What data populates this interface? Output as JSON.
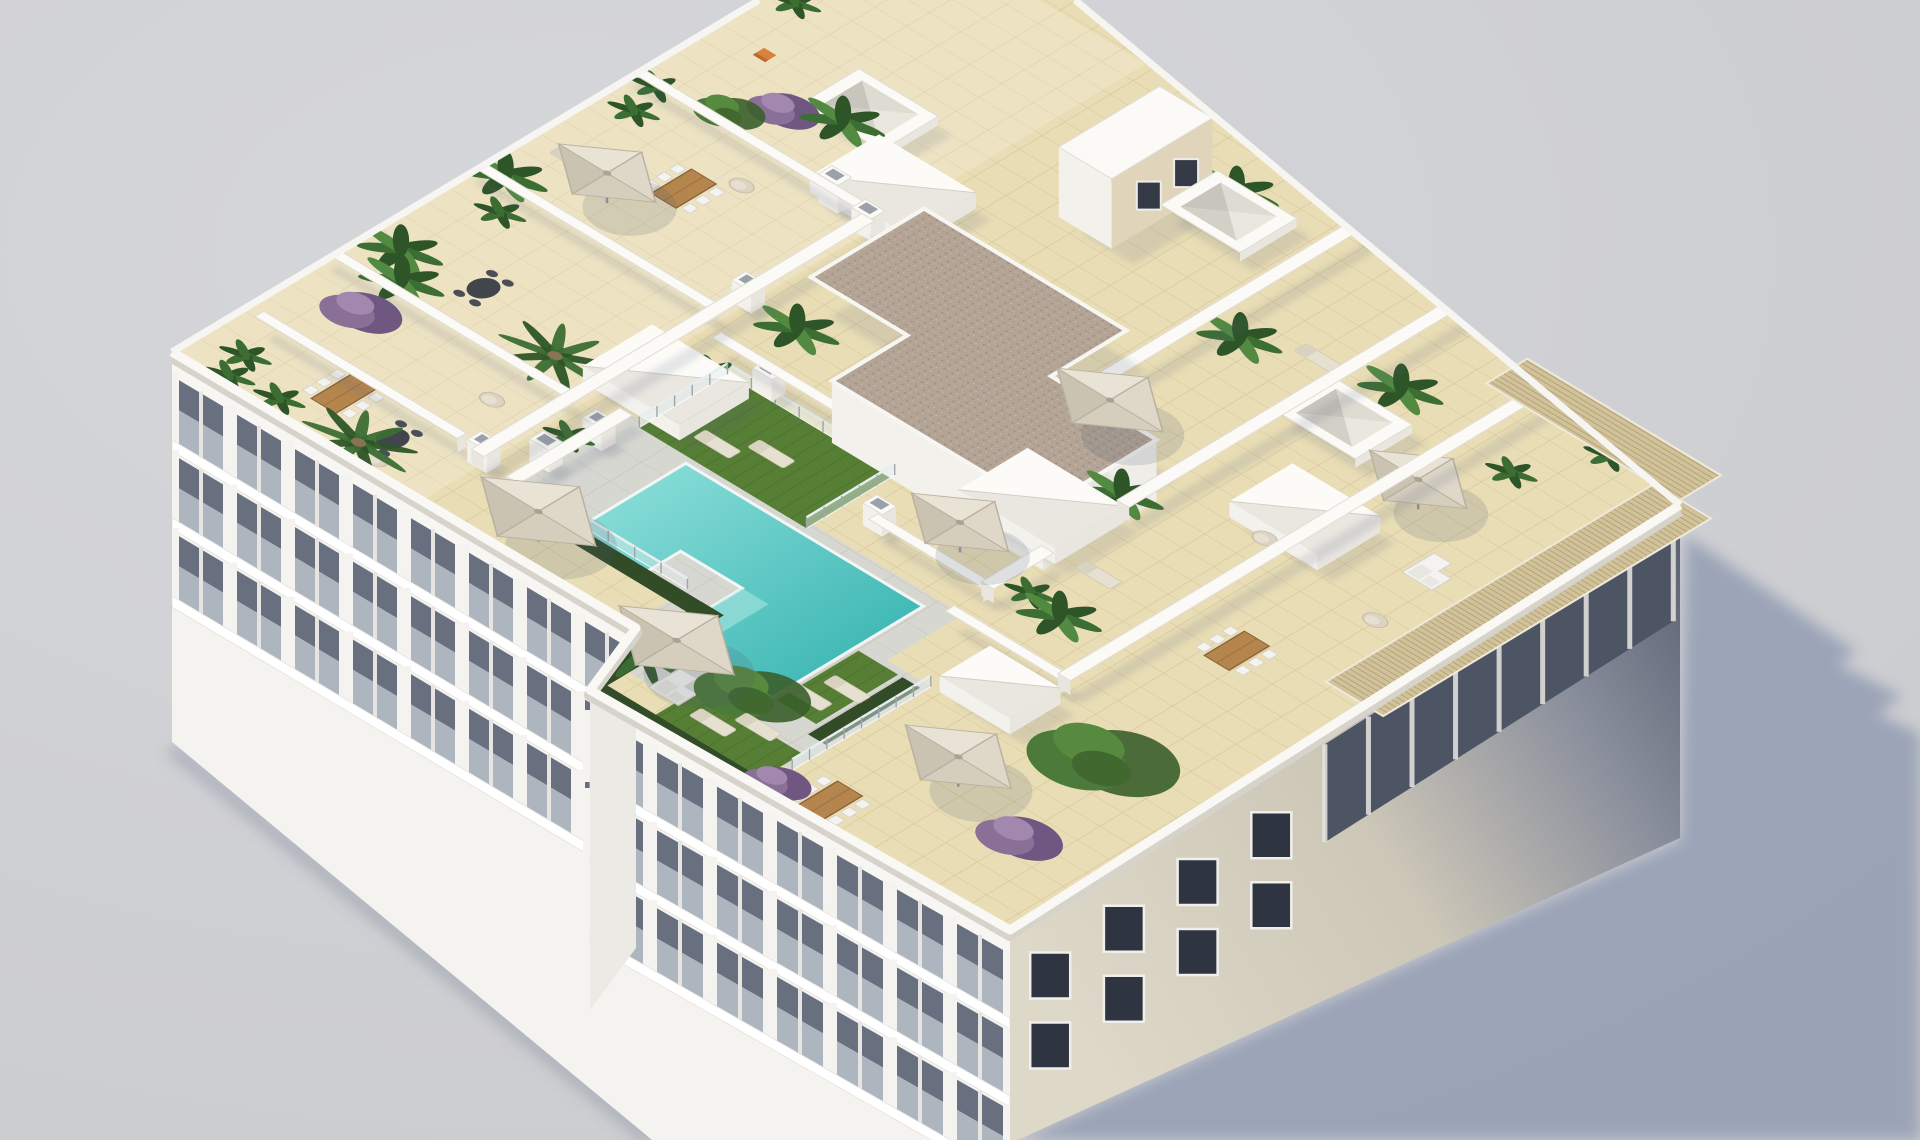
{
  "image": {
    "kind": "3d-architectural-render",
    "subject": "aerial isometric view of a white apartment building rooftop solarium with communal pool, tiled terraces, parasols, plants and outdoor furniture",
    "width": 1920,
    "height": 1140
  },
  "palette": {
    "bg": "#c9cacd",
    "bgHi": "#d6d7da",
    "groundShadow": "#98a1b6",
    "tile": "#e9ddb5",
    "tileLine": "#cdbb8d",
    "deck": "#d7d7d1",
    "deckLine": "#c2c2bb",
    "wallTop": "#fbfaf7",
    "wallFace": "#e9e6df",
    "wallFace2": "#f3f1ec",
    "wallEdge": "#e0ddd5",
    "poolLight": "#93e2dc",
    "poolDark": "#2fb0ae",
    "poolRim": "#f2f6f4",
    "grass": "#567e34",
    "grassLine": "#49702c",
    "hedge": "#324c28",
    "gravel": "#b3a496",
    "gravelDot": "#978a7c",
    "gravelDot2": "#c8bcae",
    "pergola": "#d2c29a",
    "pergolaStripe": "#a8996f",
    "facade": "#f4f3f0",
    "facadeBand": "#687080",
    "railGlass": "rgba(196,204,212,0.75)",
    "slab": "#ffffff",
    "rightA": "#ded8c9",
    "rightB": "#cdc7b8",
    "rightC": "#8a8f9c",
    "rightD": "#565d6e",
    "window": "#2e3440",
    "windowFrame": "#f0efec",
    "recess": "#4d5464",
    "mullion": "#e8e6e0",
    "wood": "#b5854e",
    "woodDark": "#8a6238",
    "furn": "#f4f3ef",
    "furnEdge": "#d7d4cc",
    "canopy1": "#e9e3d5",
    "canopy2": "#d5cebd",
    "canopy3": "#dfd8c8",
    "canopy4": "#cac3b1",
    "pole": "#8c8f94",
    "leaf": "#3c6d33",
    "leafDark": "#2d5527",
    "leafLight": "#538a42",
    "trunk": "#8a7354",
    "pot": "#c9beac",
    "potDark": "#b3a894",
    "purple": "#8a6f96",
    "purpleDark": "#6f5781",
    "purpleLight": "#a287ae",
    "orange": "#d9823f",
    "ao": "rgba(80,92,120,0.14)"
  },
  "iso": {
    "a": 6.3,
    "b": -3.8,
    "c": 8.8,
    "d": 5.3,
    "e": 170,
    "f": 350
  },
  "outlines": {
    "roof": [
      [
        759,
        0
      ],
      [
        1075,
        0
      ],
      [
        1680,
        505
      ],
      [
        1010,
        930
      ],
      [
        590,
        690
      ],
      [
        636,
        628
      ],
      [
        172,
        352
      ]
    ],
    "facadeLeft": [
      [
        172,
        352
      ],
      [
        636,
        628
      ],
      [
        590,
        690
      ],
      [
        1010,
        930
      ],
      [
        1012,
        1140
      ],
      [
        652,
        1140
      ],
      [
        172,
        742
      ]
    ],
    "facadeRight": [
      [
        1010,
        930
      ],
      [
        1680,
        505
      ],
      [
        1680,
        838
      ],
      [
        1018,
        1140
      ],
      [
        1010,
        1140
      ]
    ],
    "shadow": [
      [
        1686,
        535
      ],
      [
        1857,
        652
      ],
      [
        1838,
        664
      ],
      [
        1902,
        696
      ],
      [
        1878,
        714
      ],
      [
        1920,
        734
      ],
      [
        1920,
        1140
      ],
      [
        1018,
        1140
      ],
      [
        1680,
        840
      ]
    ]
  },
  "facades": {
    "left": {
      "A": [
        172,
        352
      ],
      "B": [
        636,
        628
      ],
      "bays": 8
    },
    "wing": {
      "A": [
        590,
        690
      ],
      "B": [
        1010,
        930
      ],
      "bays": 7
    },
    "step": [
      [
        636,
        628
      ],
      [
        590,
        690
      ],
      [
        590,
        1010
      ],
      [
        636,
        948
      ]
    ],
    "right": {
      "A": [
        1010,
        930
      ],
      "B": [
        1680,
        505
      ]
    }
  },
  "floor": {
    "deck": [
      [
        8,
        32
      ],
      [
        28,
        32
      ],
      [
        28,
        70
      ],
      [
        16,
        70
      ],
      [
        16,
        75
      ],
      [
        -6,
        75
      ],
      [
        -6,
        52
      ],
      [
        8,
        52
      ]
    ],
    "pool": [
      [
        26,
        40
      ],
      [
        26,
        67
      ],
      [
        2,
        67
      ],
      [
        2,
        55
      ],
      [
        14,
        55
      ],
      [
        14,
        48
      ],
      [
        8,
        48
      ],
      [
        8,
        40
      ]
    ],
    "grass": [
      [
        [
          27,
          34
        ],
        [
          41,
          34
        ],
        [
          41,
          53
        ],
        [
          27,
          53
        ]
      ],
      [
        [
          2,
          67.5
        ],
        [
          15,
          67.5
        ],
        [
          15,
          72
        ],
        [
          2,
          72
        ]
      ],
      [
        [
          -11,
          62
        ],
        [
          -3,
          62
        ],
        [
          -3,
          74
        ],
        [
          -11,
          74
        ]
      ]
    ],
    "hedges": [
      [
        [
          6.5,
          33
        ],
        [
          9,
          33
        ],
        [
          9,
          56
        ],
        [
          6.5,
          56
        ]
      ],
      [
        [
          -12,
          54
        ],
        [
          9,
          54
        ],
        [
          9,
          56.5
        ],
        [
          -12,
          56.5
        ]
      ],
      [
        [
          -12,
          56
        ],
        [
          -9.5,
          56
        ],
        [
          -9.5,
          76
        ],
        [
          -12,
          76
        ]
      ],
      [
        [
          0,
          72.5
        ],
        [
          15,
          72.5
        ],
        [
          15,
          74.5
        ],
        [
          0,
          74.5
        ]
      ]
    ],
    "topTerraceTint": [
      [
        0,
        0
      ],
      [
        115,
        0
      ],
      [
        115,
        28.5
      ],
      [
        0,
        28.5
      ]
    ],
    "gravel": [
      [
        75,
        32
      ],
      [
        75,
        55
      ],
      [
        63,
        55
      ],
      [
        63,
        67
      ],
      [
        45,
        67
      ],
      [
        45,
        43
      ],
      [
        57,
        43
      ],
      [
        57,
        32
      ]
    ],
    "pergola": [
      [
        [
          48,
          97
        ],
        [
          100,
          97
        ],
        [
          100,
          103.5
        ],
        [
          48,
          103.5
        ]
      ],
      [
        [
          100,
          78
        ],
        [
          106.5,
          78
        ],
        [
          106.5,
          100
        ],
        [
          100,
          100
        ]
      ]
    ]
  },
  "objects": [
    {
      "t": "wall",
      "a": [
        24,
        0
      ],
      "b": [
        24,
        28
      ]
    },
    {
      "t": "wall",
      "a": [
        47,
        0
      ],
      "b": [
        47,
        28
      ]
    },
    {
      "t": "wall",
      "a": [
        72,
        0
      ],
      "b": [
        72,
        28
      ]
    },
    {
      "t": "wall",
      "a": [
        9,
        28.5
      ],
      "b": [
        71,
        28.5
      ]
    },
    {
      "t": "wall",
      "a": [
        10,
        3
      ],
      "b": [
        10,
        26
      ]
    },
    {
      "t": "wall",
      "a": [
        43.5,
        31
      ],
      "b": [
        43.5,
        47
      ]
    },
    {
      "t": "wall",
      "a": [
        55.5,
        57
      ],
      "b": [
        115,
        57
      ]
    },
    {
      "t": "wall",
      "a": [
        32,
        57
      ],
      "b": [
        32,
        70
      ]
    },
    {
      "t": "wall",
      "a": [
        32,
        70
      ],
      "b": [
        41.5,
        70
      ]
    },
    {
      "t": "wall",
      "a": [
        53.5,
        70
      ],
      "b": [
        115,
        70
      ]
    },
    {
      "t": "wall",
      "a": [
        26,
        70
      ],
      "b": [
        26,
        83
      ]
    },
    {
      "t": "wall",
      "a": [
        26,
        83
      ],
      "b": [
        115,
        83
      ]
    },
    {
      "t": "wall",
      "a": [
        9,
        32.5
      ],
      "b": [
        27,
        32.5
      ],
      "h": 8
    },
    {
      "t": "gcore"
    },
    {
      "t": "hwall"
    },
    {
      "t": "chim",
      "c": [
        10,
        28.5
      ]
    },
    {
      "t": "chim",
      "c": [
        30,
        28.5
      ]
    },
    {
      "t": "chim",
      "c": [
        52,
        28.5
      ]
    },
    {
      "t": "chim",
      "c": [
        71,
        28.5
      ]
    },
    {
      "t": "chim",
      "c": [
        15,
        32
      ]
    },
    {
      "t": "chim",
      "c": [
        22,
        33
      ]
    },
    {
      "t": "chim",
      "c": [
        42,
        38
      ]
    },
    {
      "t": "chim",
      "c": [
        33,
        57
      ]
    },
    {
      "t": "chim",
      "c": [
        72,
        24
      ],
      "h": 28
    },
    {
      "t": "sky",
      "c": [
        86,
        18
      ],
      "w": 9
    },
    {
      "t": "sky",
      "c": [
        101,
        48
      ],
      "w": 9
    },
    {
      "t": "sky",
      "c": [
        83,
        74
      ],
      "w": 9
    },
    {
      "t": "vbox",
      "c": [
        34,
        32
      ],
      "w": 11
    },
    {
      "t": "vbox",
      "c": [
        77,
        27
      ],
      "w": 11
    },
    {
      "t": "vbox",
      "c": [
        49.5,
        50
      ],
      "w": 11
    },
    {
      "t": "vbox",
      "c": [
        47.5,
        65
      ],
      "w": 11
    },
    {
      "t": "vbox",
      "c": [
        67,
        81
      ],
      "w": 10
    },
    {
      "t": "vbox",
      "c": [
        20,
        80
      ],
      "w": 8
    },
    {
      "t": "glass",
      "a": [
        27,
        34
      ],
      "b": [
        41,
        34
      ]
    },
    {
      "t": "glass",
      "a": [
        41,
        34
      ],
      "b": [
        41,
        53
      ]
    },
    {
      "t": "glass",
      "a": [
        9.5,
        34
      ],
      "b": [
        9.5,
        52
      ]
    },
    {
      "t": "glass",
      "a": [
        -6,
        75
      ],
      "b": [
        16,
        75
      ]
    },
    {
      "t": "glass",
      "a": [
        27,
        53
      ],
      "b": [
        41,
        53
      ]
    },
    {
      "t": "umb",
      "c": [
        4,
        39
      ],
      "s": 6.5
    },
    {
      "t": "umb",
      "c": [
        -2,
        59
      ],
      "s": 6.5
    },
    {
      "t": "umb",
      "c": [
        54,
        11
      ],
      "s": 5.5
    },
    {
      "t": "umb",
      "c": [
        64,
        61
      ],
      "s": 6
    },
    {
      "t": "umb",
      "c": [
        36,
        64
      ],
      "s": 5.5
    },
    {
      "t": "umb",
      "c": [
        5,
        86
      ],
      "s": 6
    },
    {
      "t": "umb",
      "c": [
        78,
        86
      ],
      "s": 5.5
    },
    {
      "t": "table",
      "c": [
        8,
        14
      ]
    },
    {
      "t": "table",
      "c": [
        62,
        14
      ]
    },
    {
      "t": "table",
      "c": [
        63,
        43
      ]
    },
    {
      "t": "table",
      "c": [
        57,
        63
      ]
    },
    {
      "t": "table",
      "c": [
        45,
        89
      ]
    },
    {
      "t": "table",
      "c": [
        -7,
        80
      ]
    },
    {
      "t": "dtable",
      "c": [
        6,
        21
      ]
    },
    {
      "t": "dtable",
      "c": [
        33,
        12
      ]
    },
    {
      "t": "pouf",
      "c": [
        19,
        23
      ]
    },
    {
      "t": "pouf",
      "c": [
        67,
        17
      ]
    },
    {
      "t": "pouf",
      "c": [
        56,
        50
      ]
    },
    {
      "t": "pouf",
      "c": [
        62,
        80
      ]
    },
    {
      "t": "pouf",
      "c": [
        60,
        94
      ]
    },
    {
      "t": "pouf",
      "c": [
        2,
        22
      ]
    },
    {
      "t": "sofa",
      "c": [
        89,
        16
      ],
      "accent": true
    },
    {
      "t": "sofa",
      "c": [
        70,
        78
      ]
    },
    {
      "t": "sofa",
      "c": [
        71,
        92
      ]
    },
    {
      "t": "sofa",
      "c": [
        -4,
        60
      ]
    },
    {
      "t": "orange",
      "c": [
        86,
        6
      ]
    },
    {
      "t": "lounger",
      "c": [
        31,
        40
      ]
    },
    {
      "t": "lounger",
      "c": [
        34,
        44
      ]
    },
    {
      "t": "lounger",
      "c": [
        5,
        69
      ]
    },
    {
      "t": "lounger",
      "c": [
        9,
        70.5
      ]
    },
    {
      "t": "lounger",
      "c": [
        -6,
        66
      ]
    },
    {
      "t": "lounger",
      "c": [
        -3,
        69
      ]
    },
    {
      "t": "lounger",
      "c": [
        57,
        5
      ]
    },
    {
      "t": "lounger",
      "c": [
        60,
        7.5
      ]
    },
    {
      "t": "lounger",
      "c": [
        44,
        74
      ]
    },
    {
      "t": "lounger",
      "c": [
        90,
        66
      ]
    },
    {
      "t": "palm",
      "c": [
        2,
        20
      ]
    },
    {
      "t": "palm",
      "c": [
        29,
        23
      ]
    },
    {
      "t": "palm",
      "c": [
        -3,
        56
      ]
    },
    {
      "t": "paddle",
      "c": [
        27,
        7
      ]
    },
    {
      "t": "paddle",
      "c": [
        31,
        4
      ]
    },
    {
      "t": "paddle",
      "c": [
        52,
        34
      ]
    },
    {
      "t": "paddle",
      "c": [
        86,
        60
      ]
    },
    {
      "t": "paddle",
      "c": [
        56,
        68
      ]
    },
    {
      "t": "paddle",
      "c": [
        35,
        76
      ]
    },
    {
      "t": "paddle",
      "c": [
        105,
        46
      ]
    },
    {
      "t": "paddle",
      "c": [
        92,
        74
      ]
    },
    {
      "t": "paddle",
      "c": [
        49,
        3
      ]
    },
    {
      "t": "paddle",
      "c": [
        83,
        17
      ]
    },
    {
      "t": "pot",
      "c": [
        5,
        5
      ]
    },
    {
      "t": "pot",
      "c": [
        44,
        6
      ]
    },
    {
      "t": "pot",
      "c": [
        73,
        3
      ]
    },
    {
      "t": "pot",
      "c": [
        95,
        3
      ]
    },
    {
      "t": "pot",
      "c": [
        20,
        31
      ]
    },
    {
      "t": "pot",
      "c": [
        40,
        33
      ]
    },
    {
      "t": "pot",
      "c": [
        98,
        36
      ]
    },
    {
      "t": "pot",
      "c": [
        36,
        72
      ]
    },
    {
      "t": "pot",
      "c": [
        100,
        92
      ]
    },
    {
      "t": "pot",
      "c": [
        68,
        4
      ]
    },
    {
      "t": "pot",
      "c": [
        90,
        88
      ]
    },
    {
      "t": "pot",
      "c": [
        1,
        6
      ]
    },
    {
      "t": "pot",
      "c": [
        2,
        11
      ]
    },
    {
      "t": "purple",
      "c": [
        19,
        8
      ],
      "r": 3.2
    },
    {
      "t": "purple",
      "c": [
        79,
        13
      ],
      "r": 2.8
    },
    {
      "t": "purple",
      "c": [
        2,
        95
      ],
      "r": 3.4
    },
    {
      "t": "purple",
      "c": [
        -10,
        76
      ],
      "r": 2.6
    },
    {
      "t": "tree",
      "c": [
        18,
        92
      ],
      "r": 5.5
    },
    {
      "t": "tree",
      "c": [
        -1,
        66
      ],
      "r": 4.2
    },
    {
      "t": "tree",
      "c": [
        74,
        10
      ],
      "r": 2.6
    },
    {
      "t": "gbush",
      "c": [
        16,
        90
      ],
      "r": 2
    },
    {
      "t": "gbush",
      "c": [
        5,
        35
      ],
      "r": 1.8
    }
  ]
}
